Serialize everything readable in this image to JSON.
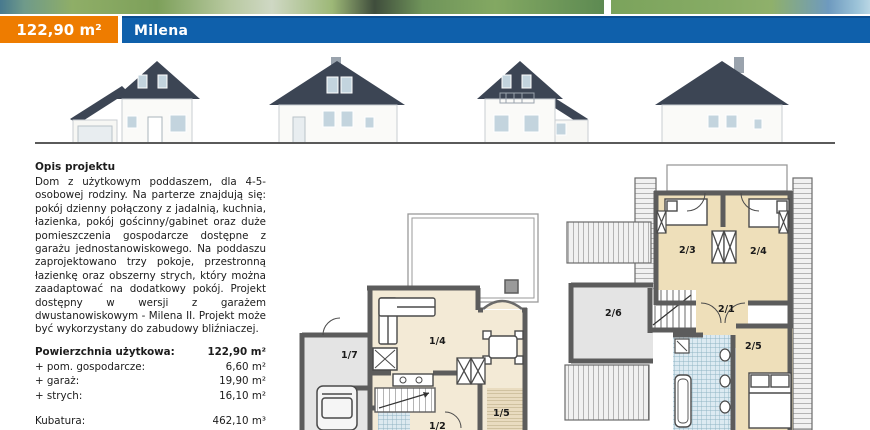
{
  "header": {
    "area_label": "122,90 m²",
    "project_name": "Milena"
  },
  "colors": {
    "accent_orange": "#ee7c00",
    "accent_blue": "#0f60ab",
    "roof": "#3c4554",
    "floor_beige": "#f3ead6",
    "floor_gray": "#e4e4e4",
    "tile_blue": "#8fb2c2"
  },
  "description": {
    "heading": "Opis projektu",
    "body": "Dom z użytkowym poddaszem, dla 4-5-osobowej rodziny. Na parterze znajdują się: pokój dzienny połączony z jadalnią, kuchnia, łazienka, pokój gościnny/gabinet oraz duże pomieszczenia gospodarcze dostępne z garażu jednostanowiskowego. Na poddaszu zaprojektowano trzy pokoje, przestronną łazienkę oraz obszerny strych, który można zaadaptować na dodatkowy pokój. Projekt dostępny w wersji z garażem dwustanowiskowym - Milena II. Projekt może być wykorzystany do zabudowy bliźniaczej."
  },
  "stats": {
    "rows": [
      {
        "label": "Powierzchnia użytkowa:",
        "value": "122,90 m²"
      },
      {
        "label": "+ pom. gospodarcze:",
        "value": "6,60 m²"
      },
      {
        "label": "+ garaż:",
        "value": "19,90 m²"
      },
      {
        "label": "+ strych:",
        "value": "16,10 m²"
      },
      {
        "label": "Kubatura:",
        "value": "462,10 m³"
      },
      {
        "label": "Wymiary budynku:",
        "value": "10,00 m x 11,00 m"
      }
    ]
  },
  "floorplans": {
    "ground": {
      "labels": {
        "r17": "1/7",
        "r14": "1/4",
        "r12": "1/2",
        "r15": "1/5"
      }
    },
    "attic": {
      "labels": {
        "r23": "2/3",
        "r24": "2/4",
        "r26": "2/6",
        "r21": "2/1",
        "r25": "2/5"
      }
    }
  }
}
